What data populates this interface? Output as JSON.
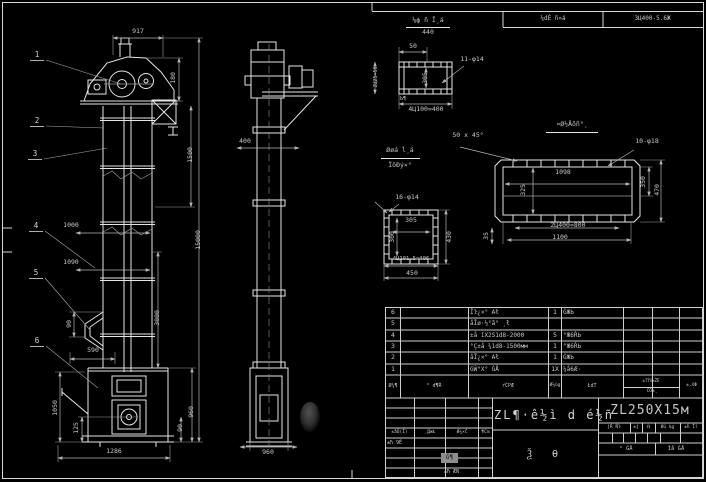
{
  "strip": {
    "label": "¼dÈ ñ»á",
    "model": "3Ц400-5.6Ж"
  },
  "balloons": {
    "b1": "1",
    "b2": "2",
    "b3": "3",
    "b4": "4",
    "b5": "5",
    "b6": "6"
  },
  "front": {
    "d917": "917",
    "d180": "180",
    "d1500": "1500",
    "d15000": "15000",
    "d3000": "3000",
    "d960": "960",
    "d90b": "90",
    "d1000": "1000",
    "d1090": "1090",
    "d90a": "90",
    "d590": "590",
    "d1050": "1050",
    "d125": "125",
    "d1286": "1286"
  },
  "side": {
    "d400": "400",
    "d960": "960"
  },
  "dtop": {
    "title": "⅛ф ñ Ī¸á",
    "sub": "440",
    "d50": "50",
    "holes": "11-φ14",
    "inner": "305",
    "left": "2Ц25=50",
    "note": "Ь¶",
    "bottom": "4Ц100=400"
  },
  "dmid": {
    "t1": "Øøá ĺ¸á",
    "t2": "ÏôÐý×°",
    "holes": "16-φ14",
    "iw": "305",
    "ih": "300",
    "right": "430",
    "pitch": "4Ц101.5=406",
    "total": "450"
  },
  "dright": {
    "title": "¤Ø½Åõñ°¸",
    "chamfer": "50 x 45°",
    "holes": "10-φ18",
    "iw": "1098",
    "ih": "325",
    "ra": "350",
    "rb": "470",
    "pitch": "2Ц400=800",
    "mid": "1100",
    "small": "35"
  },
  "bom": {
    "rows": [
      {
        "no": "6",
        "desc": "Ĩŀ¿×° Ał",
        "qty": "1",
        "mat": "ĠЖЬ"
      },
      {
        "no": "5",
        "desc": "åĪø·½°ã° ¸ł",
        "qty": "",
        "mat": ""
      },
      {
        "no": "4",
        "desc": "±å ĭX2Ѕ1d8-2000",
        "qty": "5",
        "mat": "°Ж6ŘЬ"
      },
      {
        "no": "3",
        "desc": "°Ç±å ¾1d8-1500мм",
        "qty": "1",
        "mat": "°Ж6ŘЬ"
      },
      {
        "no": "2",
        "desc": "åĨ¿×° Ał",
        "qty": "1",
        "mat": "ĠЖЬ"
      },
      {
        "no": "1",
        "desc": "GŴ°X° ĠÅ",
        "qty": "1X",
        "mat": "¼å6Æ·"
      }
    ],
    "h": {
      "no": "Ø¼¶",
      "code": "° d¶Ŕ",
      "name": "ŕĆРÆ",
      "qty": "Ø¼ûg",
      "mat": "ŁdТ",
      "wt": "±ТŶX±ŽĒ",
      "wt2": "ĆŌ±¸",
      "note": "±,XΦ"
    }
  },
  "tb": {
    "model": "ZL250X15м",
    "title": "ZL¶·ê½ì d é½ñ",
    "doc": "Ѯ  Ѳ",
    "sh1": "±åŨ(Ĭ)",
    "sh2": "¸ДжŁ",
    "sh3": "Ø¼×Ċ",
    "sh4": "¶Ćm",
    "r1": "±ħ 9Ĕ",
    "stamp": "Ġ¶",
    "r2": "±Ћ ÆÑ",
    "sc1": "ĵŔ Ňŀ",
    "sc2": "±ĵ",
    "sc3": "Ҋ",
    "sc4": "Øü ķg",
    "sc5": "±ĥ Ĭſ",
    "sheet1": "° ĠÅ",
    "sheet2": "Ìå ĠÅ"
  }
}
